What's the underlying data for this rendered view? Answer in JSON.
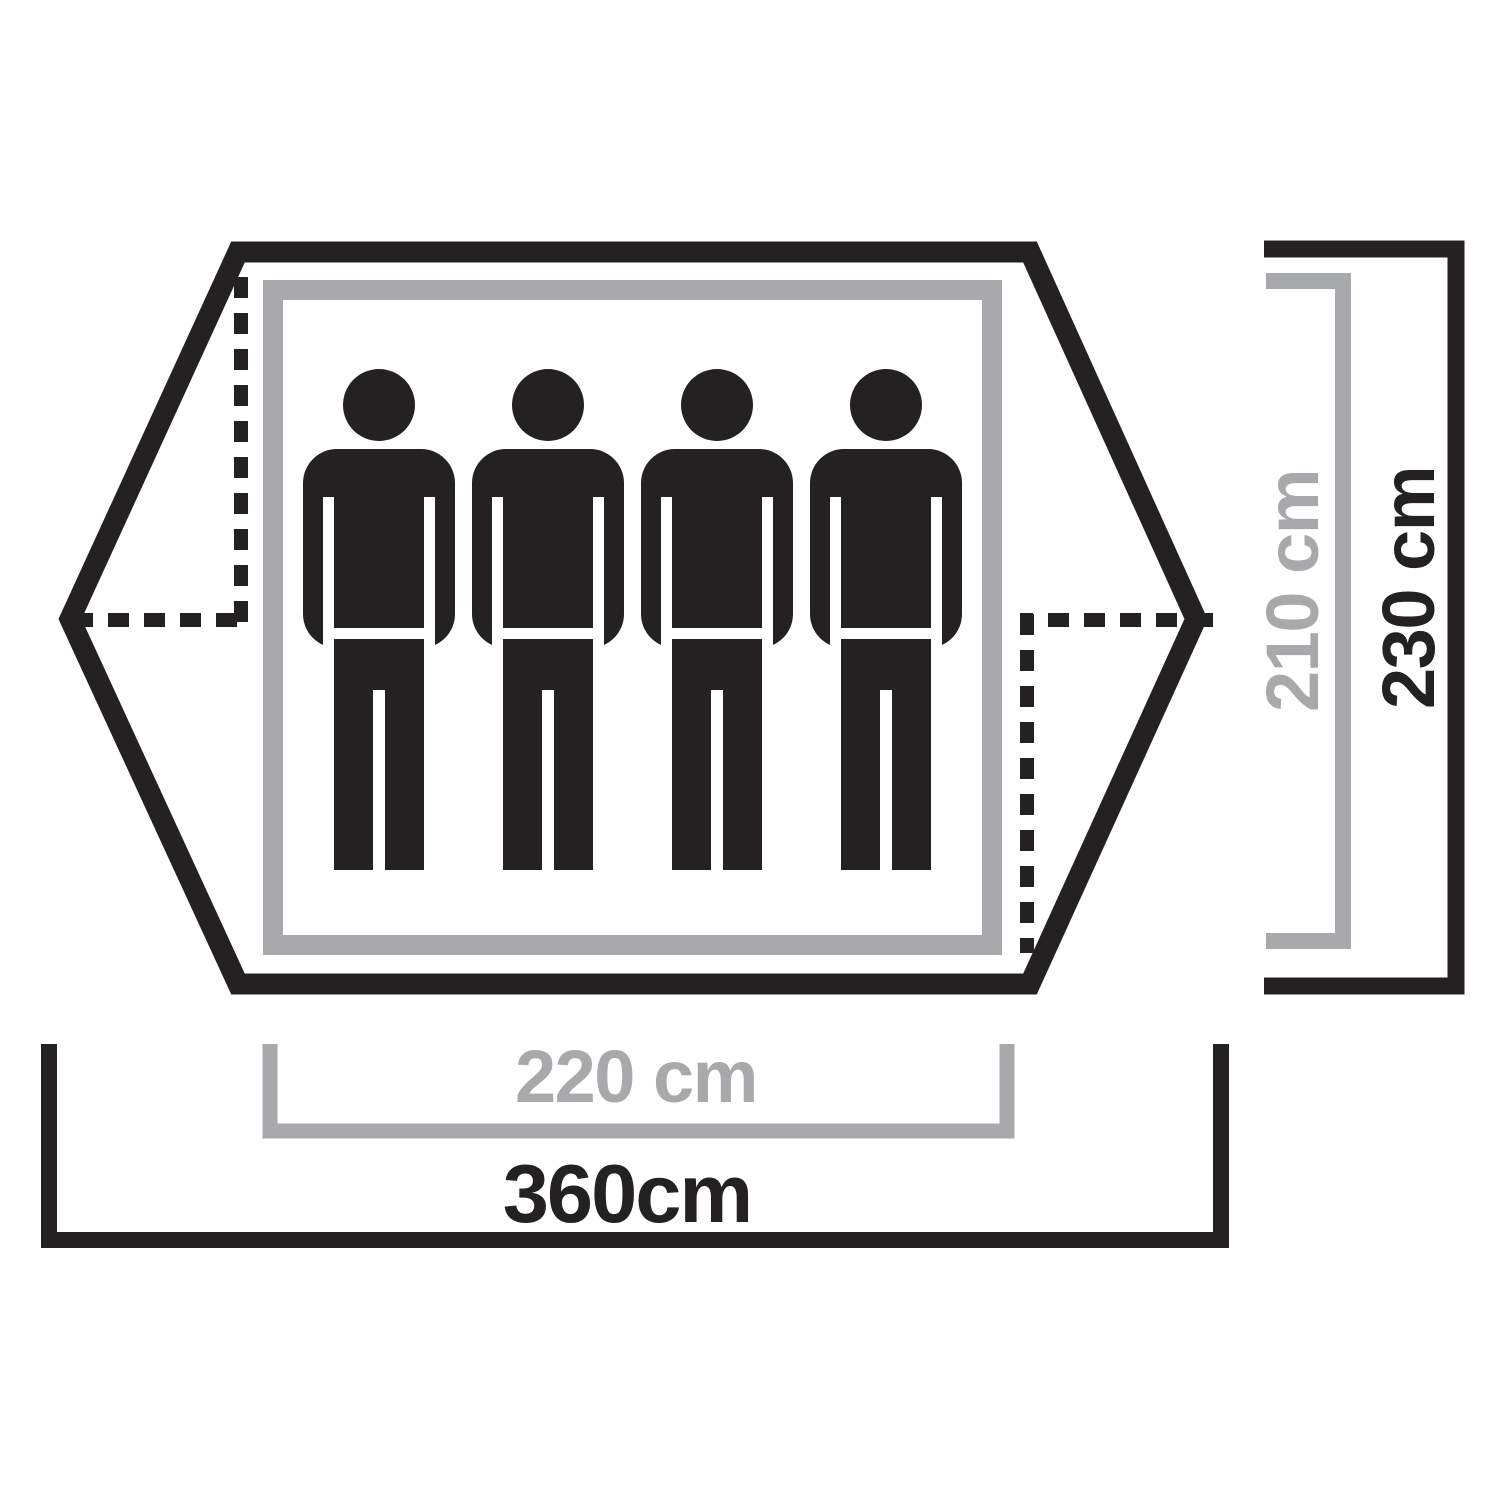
{
  "diagram": {
    "title": "Tent floor plan dimension diagram",
    "persons": 4,
    "labels": {
      "inner_width": "220 cm",
      "inner_depth": "210 cm",
      "total_width": "360cm",
      "total_depth": "230 cm"
    },
    "colors": {
      "ink": "#242122",
      "muted": "#a7a9aa",
      "background": "#ffffff"
    }
  }
}
